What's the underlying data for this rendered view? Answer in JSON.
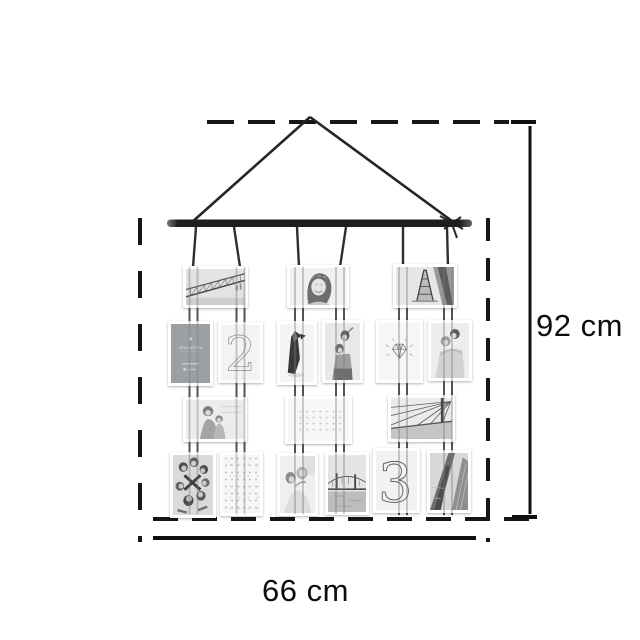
{
  "page": {
    "background": "#ffffff"
  },
  "diagram": {
    "type": "product-dimension-diagram",
    "product": "hanging photo collage wall display with wooden bar and cords",
    "height_label": "92 cm",
    "width_label": "66 cm",
    "line_color": "#141414",
    "dash_color": "#161616",
    "bar_color": "#1e1e1e",
    "cord_color": "#3d3d3d"
  },
  "collage": {
    "rows": 4,
    "columns": 3,
    "cards": {
      "brand": "atmosphera",
      "numeral_two": "2",
      "numeral_three": "3",
      "plus_row": "+ + + + + + +"
    },
    "photos": [
      {
        "row": 1,
        "kind": "truss-bridge-photo",
        "desc": "black and white truss bridge over river"
      },
      {
        "row": 1,
        "kind": "smiling-woman-photo",
        "desc": "smiling woman portrait"
      },
      {
        "row": 1,
        "kind": "eiffel-tower-photo",
        "desc": "Eiffel tower seen from below"
      },
      {
        "row": 2,
        "kind": "brand-card",
        "desc": "gray atmosphera brand card"
      },
      {
        "row": 2,
        "kind": "numeral-2-card",
        "desc": "card with large thin numeral 2"
      },
      {
        "row": 2,
        "kind": "origami-penguin-card",
        "desc": "origami penguin illustration"
      },
      {
        "row": 2,
        "kind": "two-women-photo",
        "desc": "two women piggyback photo"
      },
      {
        "row": 2,
        "kind": "diamond-card",
        "desc": "hand drawn diamond sketch"
      },
      {
        "row": 2,
        "kind": "hugging-couple-photo",
        "desc": "couple hugging photo"
      },
      {
        "row": 3,
        "kind": "family-photo",
        "desc": "parent and child photo"
      },
      {
        "row": 3,
        "kind": "plus-pattern-card",
        "desc": "card with grid of plus signs"
      },
      {
        "row": 3,
        "kind": "bridge-cables-photo",
        "desc": "suspension bridge cables"
      },
      {
        "row": 4,
        "kind": "friends-group-photo",
        "desc": "group of friends seen from above"
      },
      {
        "row": 4,
        "kind": "speckle-card",
        "desc": "card with faint dotted pattern"
      },
      {
        "row": 4,
        "kind": "couple-photo",
        "desc": "smiling couple photo"
      },
      {
        "row": 4,
        "kind": "bridge-photo",
        "desc": "bridge with towers over water"
      },
      {
        "row": 4,
        "kind": "numeral-3-card",
        "desc": "card with large thin numeral 3"
      },
      {
        "row": 4,
        "kind": "buildings-photo",
        "desc": "skyscraper diagonal perspective"
      }
    ]
  }
}
